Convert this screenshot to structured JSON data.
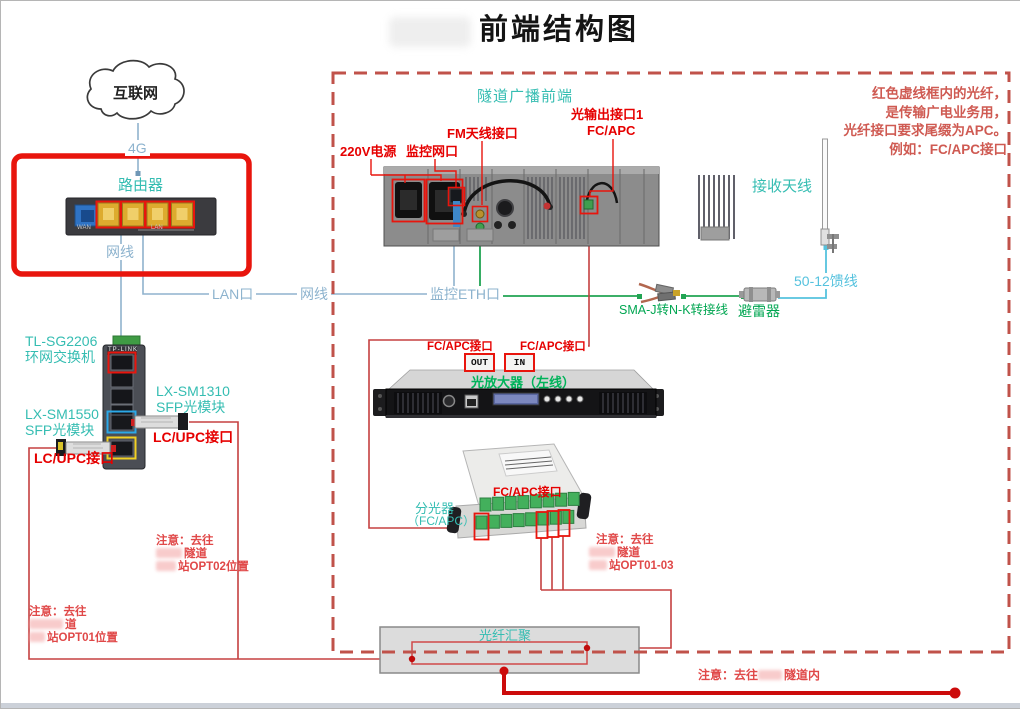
{
  "title": "前端结构图",
  "colors": {
    "accent_red": "#e8150d",
    "label_red": "#e60000",
    "note_red": "#e04848",
    "dashed_border_red": "#c0524a",
    "teal": "#35bdb2",
    "line_blue": "#8db3ce",
    "feeder_cyan": "#55c2de",
    "green": "#00a651"
  },
  "cloud_label": "互联网",
  "access": {
    "link_4g": "4G",
    "router": "路由器",
    "cable": "网线",
    "wan": "WAN",
    "lan": "LAN",
    "lan_port": "LAN口",
    "lan_cable": "网线",
    "eth_port": "监控ETH口",
    "switch_brand": "TP-LINK",
    "switch_model": "TL-SG2206",
    "switch_name": "环网交换机",
    "sfp1310_model": "LX-SM1310",
    "sfp1310_name": "SFP光模块",
    "sfp1310_port": "LC/UPC接口",
    "sfp1550_model": "LX-SM1550",
    "sfp1550_name": "SFP光模块",
    "sfp1550_port": "LC/UPC接口"
  },
  "headend": {
    "zone": "隧道广播前端",
    "power": "220V电源",
    "monitor_port": "监控网口",
    "fm_port": "FM天线接口",
    "optical_port_line1": "光输出接口1",
    "optical_port_line2": "FC/APC",
    "antenna": "接收天线",
    "feeder": "50-12馈线",
    "arrester": "避雷器",
    "adapter": "SMA-J转N-K转接线",
    "amp_name": "光放大器（左线）",
    "amp_out": "OUT",
    "amp_in": "IN",
    "amp_out_port": "FC/APC接口",
    "amp_in_port": "FC/APC接口",
    "splitter_name": "分光器",
    "splitter_type": "（FC/APC）",
    "splitter_port": "FC/APC接口",
    "apc_note": [
      "红色虚线框内的光纤，",
      "是传输广电业务用，",
      "光纤接口要求尾缀为APC。",
      "例如：FC/APC接口"
    ]
  },
  "fiber": {
    "aggregation": "光纤汇聚",
    "note_opt02": {
      "l1": "注意：去往",
      "l2": "隧道",
      "l3": "站OPT02位置"
    },
    "note_opt01": {
      "l1": "注意：去往",
      "l2": "道",
      "l3": "站OPT01位置"
    },
    "note_opt0103": {
      "l1": "注意：去往",
      "l2": "隧道",
      "l3": "站OPT01-03"
    },
    "note_tunnel_prefix": "注意：去往",
    "note_tunnel_suffix": "隧道内"
  }
}
